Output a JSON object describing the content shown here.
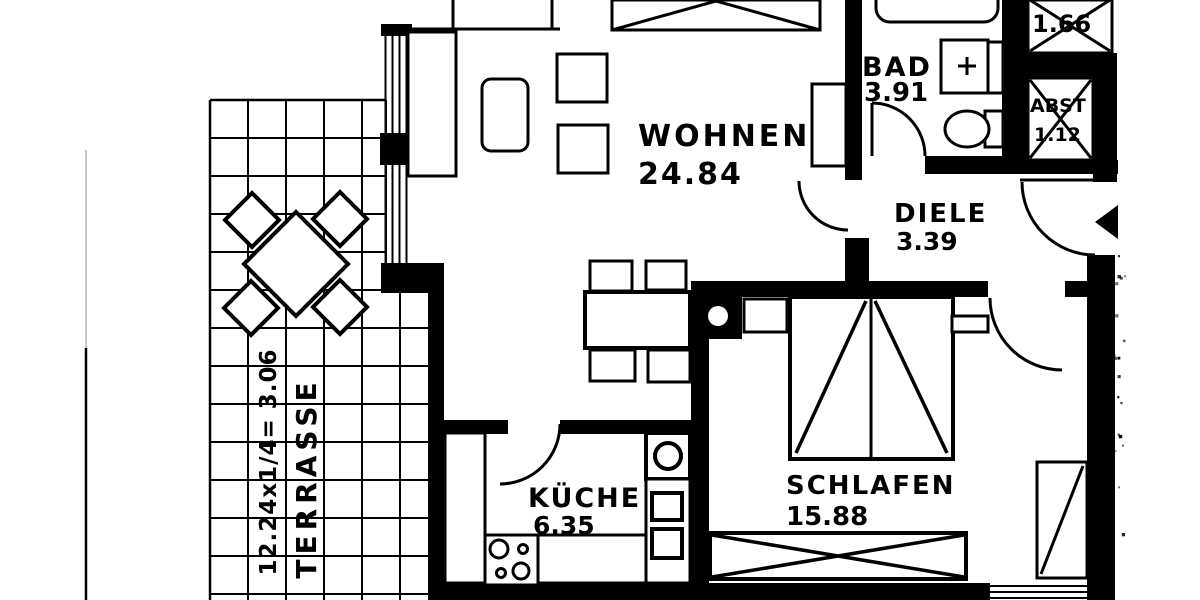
{
  "plan": {
    "kind": "apartment floor plan",
    "language": "de"
  },
  "rooms": [
    {
      "name": "WOHNEN",
      "area": "24.84"
    },
    {
      "name": "BAD",
      "area": "3.91"
    },
    {
      "name": "DIELE",
      "area": "3.39"
    },
    {
      "name": "KÜCHE",
      "area": "6.35"
    },
    {
      "name": "SCHLAFEN",
      "area": "15.88"
    },
    {
      "name": "ABST",
      "area": "1.12"
    },
    {
      "name": "",
      "area": "1.66"
    },
    {
      "name": "TERRASSE",
      "dimension": "12.24x1/4= 3.06"
    }
  ],
  "symbols": {
    "entrance-arrow": "solid triangle pointing into hallway",
    "crossed-box": "shaft / storage marked with X",
    "door-arc": "quarter-circle swing"
  },
  "colors": {
    "ink": "#000000",
    "paper": "#ffffff"
  }
}
